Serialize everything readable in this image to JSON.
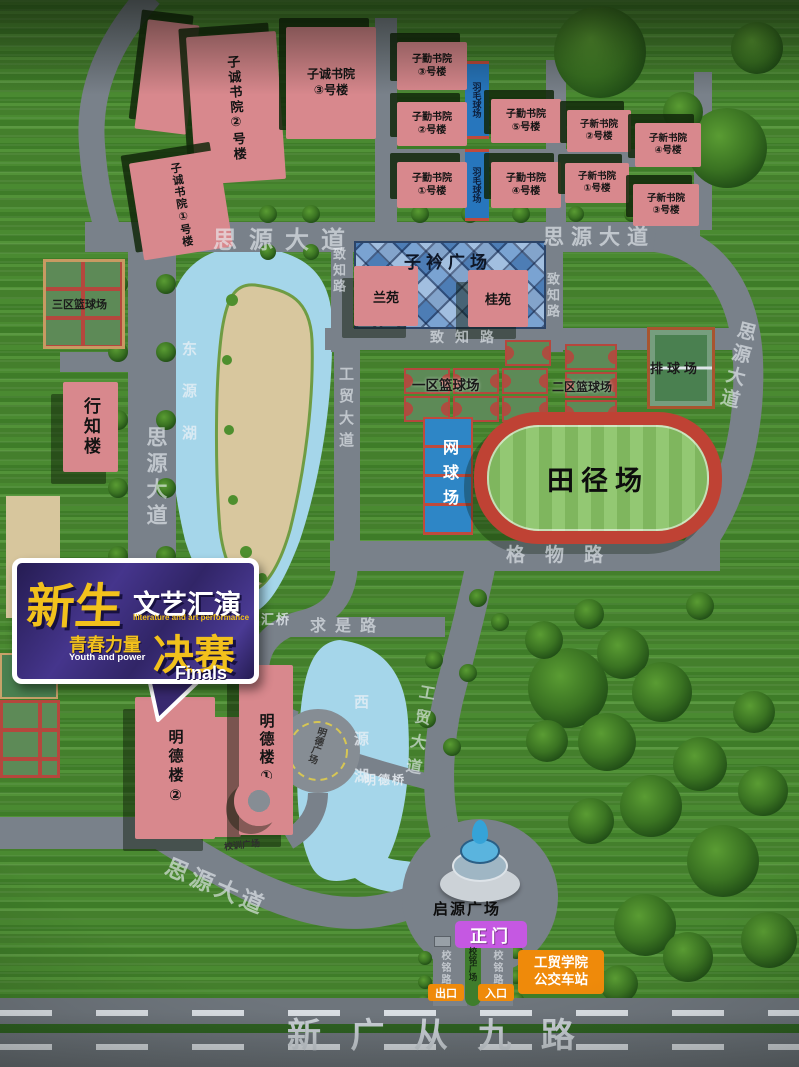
{
  "banner": {
    "main": "新生",
    "sub": "文艺汇演",
    "sub_en": "lliterature and art performance",
    "slogan": "青春力量",
    "slogan_en": "Youth and power",
    "stage": "决赛",
    "stage_en": "Finals"
  },
  "roads": {
    "siyuan": "思源大道",
    "zhizhi": "致知路",
    "gewu": "格物路",
    "qiushi": "求是路",
    "gongmao": "工贸大道",
    "xinguangcongjiu": "新 广 从 九 路",
    "xiaoming": "校铭路"
  },
  "bridges": {
    "zhihui": "智汇桥",
    "mingde": "明德桥"
  },
  "lakes": {
    "dongyuan": "东源湖",
    "xiyuan": "西源湖"
  },
  "plazas": {
    "zijin": "子衿广场",
    "mingde": "明德广场",
    "xiaoxun": "校训广场",
    "qiyuan": "启源广场",
    "xiaoming": "校铭广场"
  },
  "buildings": {
    "zicheng2": "子诚书院②号楼",
    "zicheng1": "子诚书院①号楼",
    "zicheng3": {
      "l1": "子诚书院",
      "l2": "③号楼"
    },
    "ziqin3": {
      "l1": "子勤书院",
      "l2": "③号楼"
    },
    "ziqin2": {
      "l1": "子勤书院",
      "l2": "②号楼"
    },
    "ziqin1": {
      "l1": "子勤书院",
      "l2": "①号楼"
    },
    "ziqin5": {
      "l1": "子勤书院",
      "l2": "⑤号楼"
    },
    "ziqin4": {
      "l1": "子勤书院",
      "l2": "④号楼"
    },
    "zixin2": {
      "l1": "子新书院",
      "l2": "②号楼"
    },
    "zixin4": {
      "l1": "子新书院",
      "l2": "④号楼"
    },
    "zixin1": {
      "l1": "子新书院",
      "l2": "①号楼"
    },
    "zixin3": {
      "l1": "子新书院",
      "l2": "③号楼"
    },
    "lanyuan": "兰苑",
    "guiyuan": "桂苑",
    "xingzhi": "行知楼",
    "mingde2": "明德楼②",
    "mingde1": "明德楼①"
  },
  "sports": {
    "badminton": "羽毛球场",
    "bb1": "一区篮球场",
    "bb2": "二区篮球场",
    "bb3": "三区篮球场",
    "volleyball": "排球场",
    "tennis": "网球场",
    "track": "田径场"
  },
  "gate": {
    "main": "正门",
    "exit": "出口",
    "entrance": "入口",
    "bus1": "工贸学院",
    "bus2": "公交车站"
  },
  "colors": {
    "building_pink": "#d8888d",
    "road_gray": "#79818a",
    "lake_blue": "#a5d6ea",
    "banner_purple": "#38296f",
    "gold": "#f2c11c",
    "badge_orange": "#ef8a0a",
    "gate_magenta": "#c558e2"
  }
}
